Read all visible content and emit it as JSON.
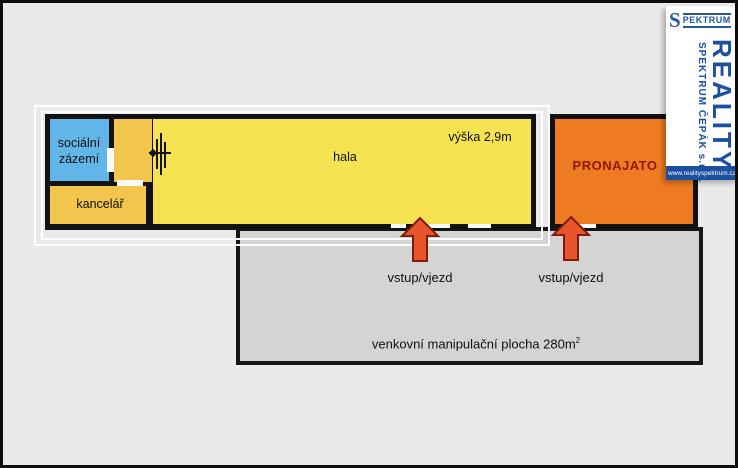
{
  "plan": {
    "rooms": {
      "social": {
        "lines": [
          "sociální",
          "zázemí"
        ]
      },
      "office": {
        "label": "kancelář"
      },
      "hala": {
        "label": "hala",
        "height_note": "výška 2,9m"
      },
      "rented": {
        "label": "PRONAJATO"
      }
    },
    "outdoor": {
      "label_base": "venkovní manipulační plocha 280m",
      "label_sup": "2"
    },
    "entrances": [
      {
        "label": "vstup/vjezd"
      },
      {
        "label": "vstup/vjezd"
      }
    ]
  },
  "logo": {
    "mini_s": "S",
    "mini_word": "PEKTRUM",
    "reality": "REALITY",
    "company": "SPEKTRUM ČEPÁK s.r.o.",
    "website": "www.realityspektrum.cz"
  },
  "colors": {
    "room_social": "#62b5e9",
    "room_office": "#f2c64d",
    "room_hala": "#f6e351",
    "room_rented": "#ee7b22",
    "rented_text": "#8e1a0a",
    "arrow": "#e8542b",
    "arrow_outline": "#801c0c",
    "outdoor_gray": "#d4d4d4",
    "logo_blue": "#1b4fa0",
    "background": "#eaeaea"
  }
}
